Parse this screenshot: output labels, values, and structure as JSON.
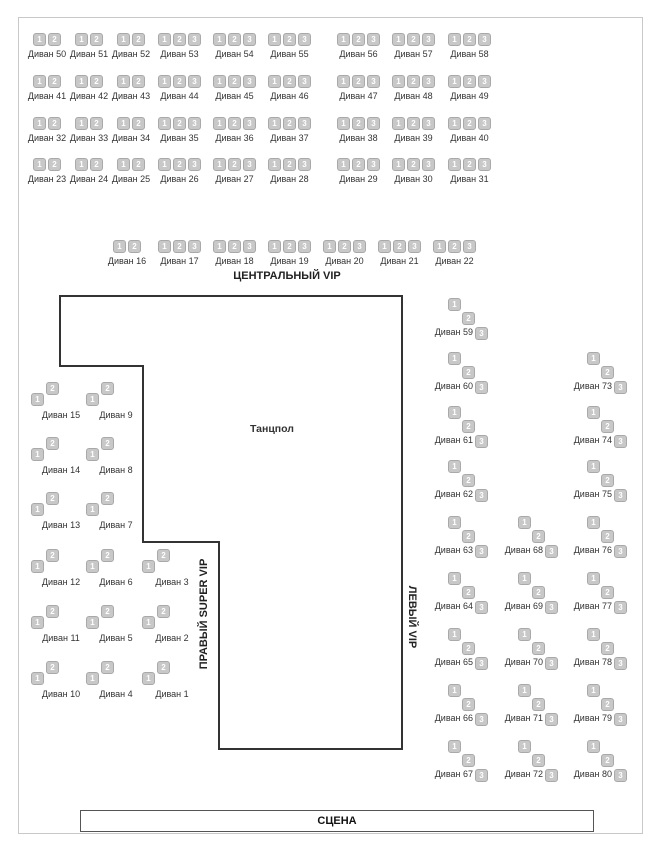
{
  "areas": {
    "central_vip": "ЦЕНТРАЛЬНЫЙ VIP",
    "right_super_vip": "ПРАВЫЙ SUPER VIP",
    "left_vip": "ЛЕВЫЙ VIP",
    "dancefloor": "Танцпол",
    "stage": "СЦЕНА"
  },
  "sofa_label_prefix": "Диван",
  "seat_numbers": [
    "1",
    "2",
    "3"
  ],
  "colors": {
    "seat_fill": "#c8c8c8",
    "seat_border": "#a9a9a9",
    "seat_text": "#ffffff",
    "outline": "#333333",
    "map_border": "#c8c8c8"
  },
  "top_grid": {
    "rows": [
      [
        {
          "num": 50,
          "seats": 2
        },
        {
          "num": 51,
          "seats": 2
        },
        {
          "num": 52,
          "seats": 2
        },
        {
          "num": 53,
          "seats": 3
        },
        {
          "num": 54,
          "seats": 3
        },
        {
          "num": 55,
          "seats": 3
        },
        {
          "num": 56,
          "seats": 3
        },
        {
          "num": 57,
          "seats": 3
        },
        {
          "num": 58,
          "seats": 3
        }
      ],
      [
        {
          "num": 41,
          "seats": 2
        },
        {
          "num": 42,
          "seats": 2
        },
        {
          "num": 43,
          "seats": 2
        },
        {
          "num": 44,
          "seats": 3
        },
        {
          "num": 45,
          "seats": 3
        },
        {
          "num": 46,
          "seats": 3
        },
        {
          "num": 47,
          "seats": 3
        },
        {
          "num": 48,
          "seats": 3
        },
        {
          "num": 49,
          "seats": 3
        }
      ],
      [
        {
          "num": 32,
          "seats": 2
        },
        {
          "num": 33,
          "seats": 2
        },
        {
          "num": 34,
          "seats": 2
        },
        {
          "num": 35,
          "seats": 3
        },
        {
          "num": 36,
          "seats": 3
        },
        {
          "num": 37,
          "seats": 3
        },
        {
          "num": 38,
          "seats": 3
        },
        {
          "num": 39,
          "seats": 3
        },
        {
          "num": 40,
          "seats": 3
        }
      ],
      [
        {
          "num": 23,
          "seats": 2
        },
        {
          "num": 24,
          "seats": 2
        },
        {
          "num": 25,
          "seats": 2
        },
        {
          "num": 26,
          "seats": 3
        },
        {
          "num": 27,
          "seats": 3
        },
        {
          "num": 28,
          "seats": 3
        },
        {
          "num": 29,
          "seats": 3
        },
        {
          "num": 30,
          "seats": 3
        },
        {
          "num": 31,
          "seats": 3
        }
      ]
    ]
  },
  "center_row": [
    {
      "num": 16,
      "seats": 2
    },
    {
      "num": 17,
      "seats": 3
    },
    {
      "num": 18,
      "seats": 3
    },
    {
      "num": 19,
      "seats": 3
    },
    {
      "num": 20,
      "seats": 3
    },
    {
      "num": 21,
      "seats": 3
    },
    {
      "num": 22,
      "seats": 3
    }
  ],
  "right_super_vip_section": {
    "seats_per_sofa": 2,
    "rows": [
      [
        {
          "num": 15,
          "col": 0
        },
        {
          "num": 9,
          "col": 1
        }
      ],
      [
        {
          "num": 14,
          "col": 0
        },
        {
          "num": 8,
          "col": 1
        }
      ],
      [
        {
          "num": 13,
          "col": 0
        },
        {
          "num": 7,
          "col": 1
        }
      ],
      [
        {
          "num": 12,
          "col": 0
        },
        {
          "num": 6,
          "col": 1
        },
        {
          "num": 3,
          "col": 2
        }
      ],
      [
        {
          "num": 11,
          "col": 0
        },
        {
          "num": 5,
          "col": 1
        },
        {
          "num": 2,
          "col": 2
        }
      ],
      [
        {
          "num": 10,
          "col": 0
        },
        {
          "num": 4,
          "col": 1
        },
        {
          "num": 1,
          "col": 2
        }
      ]
    ]
  },
  "left_vip_section": {
    "seats_per_sofa": 3,
    "rows": [
      [
        {
          "num": 59,
          "col": 0
        }
      ],
      [
        {
          "num": 60,
          "col": 0
        },
        {
          "num": 73,
          "col": 2
        }
      ],
      [
        {
          "num": 61,
          "col": 0
        },
        {
          "num": 74,
          "col": 2
        }
      ],
      [
        {
          "num": 62,
          "col": 0
        },
        {
          "num": 75,
          "col": 2
        }
      ],
      [
        {
          "num": 63,
          "col": 0
        },
        {
          "num": 68,
          "col": 1
        },
        {
          "num": 76,
          "col": 2
        }
      ],
      [
        {
          "num": 64,
          "col": 0
        },
        {
          "num": 69,
          "col": 1
        },
        {
          "num": 77,
          "col": 2
        }
      ],
      [
        {
          "num": 65,
          "col": 0
        },
        {
          "num": 70,
          "col": 1
        },
        {
          "num": 78,
          "col": 2
        }
      ],
      [
        {
          "num": 66,
          "col": 0
        },
        {
          "num": 71,
          "col": 1
        },
        {
          "num": 79,
          "col": 2
        }
      ],
      [
        {
          "num": 67,
          "col": 0
        },
        {
          "num": 72,
          "col": 1
        },
        {
          "num": 80,
          "col": 2
        }
      ]
    ]
  }
}
